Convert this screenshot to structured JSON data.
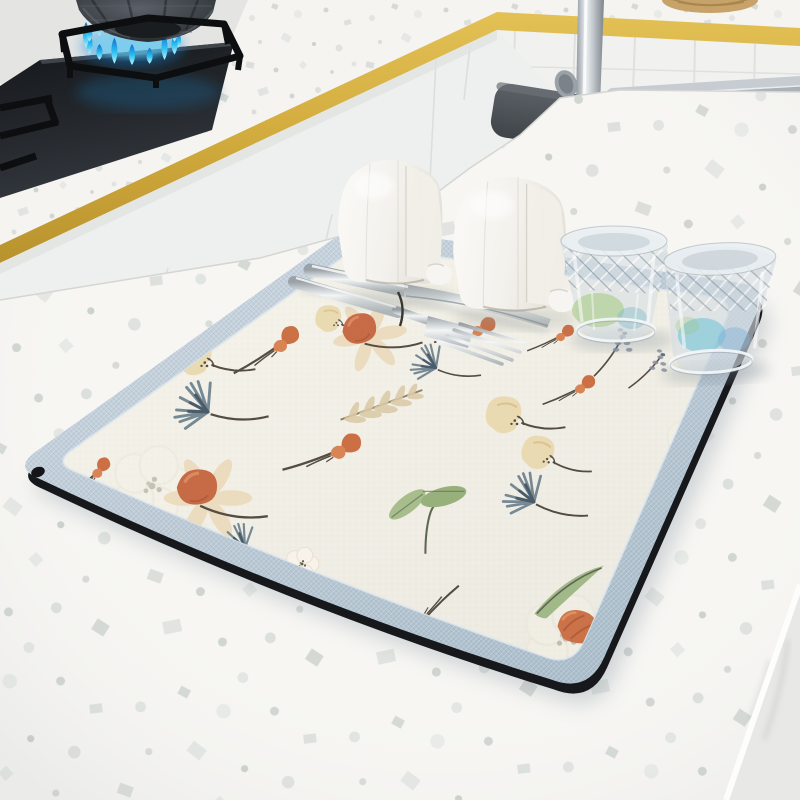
{
  "meta": {
    "description": "Product photo: floral diatomite dish-drying mat with light blue border on a white terrazzo kitchen island; background shows a gas cooktop with blue flame under a pot, a gold trim band, white tiled wall, stainless sink and chrome faucet",
    "visible_text": "none"
  },
  "palette": {
    "wall": "#e9eae8",
    "tile_wall": "#f1f1ef",
    "gold_trim": "#d2ab3e",
    "gold_trim_dark": "#b8922c",
    "cabinet_front": "#eef0ef",
    "terrazzo_base": "#f7f6f3",
    "speckles": [
      "#e0e3df",
      "#d3d7d2",
      "#c8cdc9"
    ],
    "cooktop_black": "#1c1f22",
    "flame_blue": "#2ec0f0",
    "flame_deep": "#0e6fd0",
    "pot_gray": "#3c4146",
    "grate_black": "#0d0e10",
    "sink_steel": "#8d959c",
    "sink_rim": "#c6ccd1",
    "chrome": "#dfe3e6",
    "faucet_plate": "#4b5055",
    "mat_border": "#bccad6",
    "mat_surface": "#f2f0e7",
    "mat_under_edge": "#17181c",
    "floral_coral": "#c4633c",
    "floral_cream": "#e8d5a8",
    "floral_green": "#9cb682",
    "floral_gray_blue": "#5e7585",
    "floral_stem": "#4a4238",
    "glass_tint_green": "#a3c97e",
    "glass_tint_teal": "#5fc0d6"
  },
  "scene": {
    "background": {
      "stove": "gas cooktop with blue flame ring under faceted pot",
      "second_burner": "partial grate at left edge",
      "trim": "gold edge band along counters",
      "wall": "white wall and square tile backsplash",
      "sink": "stainless undermount sink",
      "faucet": "chrome faucet on dark base plate",
      "trivet": "wicker trivet at top edge"
    },
    "foreground": {
      "counter": "white terrazzo island with speckles",
      "mat": "floral drying mat, cream center, light blue woven border, black base, corner grommet"
    }
  },
  "items": {
    "containers": [
      {
        "x": 336,
        "y": 158,
        "s": 1.0
      },
      {
        "x": 451,
        "y": 175,
        "s": 1.08
      }
    ],
    "glasses": [
      "crystal tumbler, green tint",
      "crystal tumbler, blue tint"
    ],
    "cutlery": [
      "knife",
      "fork"
    ]
  },
  "mat": {
    "grommet": true,
    "motifs": [
      {
        "t": "blob",
        "x": 196,
        "y": 356,
        "s": 1.1,
        "r": 0
      },
      {
        "t": "bud",
        "x": 262,
        "y": 350,
        "s": 1.2,
        "r": -8
      },
      {
        "t": "dand",
        "x": 208,
        "y": 412,
        "s": 1.2,
        "r": -5
      },
      {
        "t": "bud",
        "x": 318,
        "y": 452,
        "s": 1.3,
        "r": 5
      },
      {
        "t": "white",
        "x": 152,
        "y": 486,
        "s": 2.4,
        "r": 0,
        "o": 0.3
      },
      {
        "t": "daisy",
        "x": 208,
        "y": 498,
        "s": 1.3,
        "r": 0
      },
      {
        "t": "dand",
        "x": 245,
        "y": 548,
        "s": 0.9,
        "r": 10
      },
      {
        "t": "white",
        "x": 302,
        "y": 564,
        "s": 1.0,
        "r": 0
      },
      {
        "t": "bud",
        "x": 84,
        "y": 478,
        "s": 0.9,
        "r": -15
      },
      {
        "t": "bud",
        "x": 404,
        "y": 264,
        "s": 0.9,
        "r": -10
      },
      {
        "t": "blob",
        "x": 330,
        "y": 318,
        "s": 0.8,
        "r": 0
      },
      {
        "t": "daisy",
        "x": 370,
        "y": 336,
        "s": 1.1,
        "r": -10
      },
      {
        "t": "bud",
        "x": 462,
        "y": 330,
        "s": 1.0,
        "r": 8
      },
      {
        "t": "dand",
        "x": 436,
        "y": 368,
        "s": 0.9,
        "r": 0
      },
      {
        "t": "fern",
        "x": 384,
        "y": 404,
        "s": 1.2,
        "r": 8
      },
      {
        "t": "blob",
        "x": 506,
        "y": 414,
        "s": 1.1,
        "r": 0
      },
      {
        "t": "blob",
        "x": 540,
        "y": 452,
        "s": 1.0,
        "r": 8
      },
      {
        "t": "bud",
        "x": 566,
        "y": 390,
        "s": 0.9,
        "r": 0
      },
      {
        "t": "leaf2",
        "x": 428,
        "y": 520,
        "s": 1.3,
        "r": 0
      },
      {
        "t": "dand",
        "x": 534,
        "y": 502,
        "s": 1.1,
        "r": 5
      },
      {
        "t": "white",
        "x": 566,
        "y": 638,
        "s": 2.6,
        "r": 0,
        "o": 0.3
      },
      {
        "t": "leafc",
        "x": 568,
        "y": 592,
        "s": 1.2,
        "r": 0
      },
      {
        "t": "tulip",
        "x": 578,
        "y": 626,
        "s": 1.2,
        "r": 20
      },
      {
        "t": "bud",
        "x": 438,
        "y": 612,
        "s": 1.1,
        "r": 160
      },
      {
        "t": "white",
        "x": 612,
        "y": 618,
        "s": 0.9,
        "r": 0,
        "o": 0.6
      },
      {
        "t": "lav",
        "x": 616,
        "y": 352,
        "s": 1.1,
        "r": 0
      },
      {
        "t": "lav",
        "x": 652,
        "y": 370,
        "s": 1.0,
        "r": 10
      },
      {
        "t": "white",
        "x": 698,
        "y": 448,
        "s": 2.0,
        "r": 0,
        "o": 0.3
      },
      {
        "t": "tulip",
        "x": 700,
        "y": 420,
        "s": 1.0,
        "r": -60
      },
      {
        "t": "bud",
        "x": 548,
        "y": 338,
        "s": 0.8,
        "r": 0
      }
    ]
  }
}
